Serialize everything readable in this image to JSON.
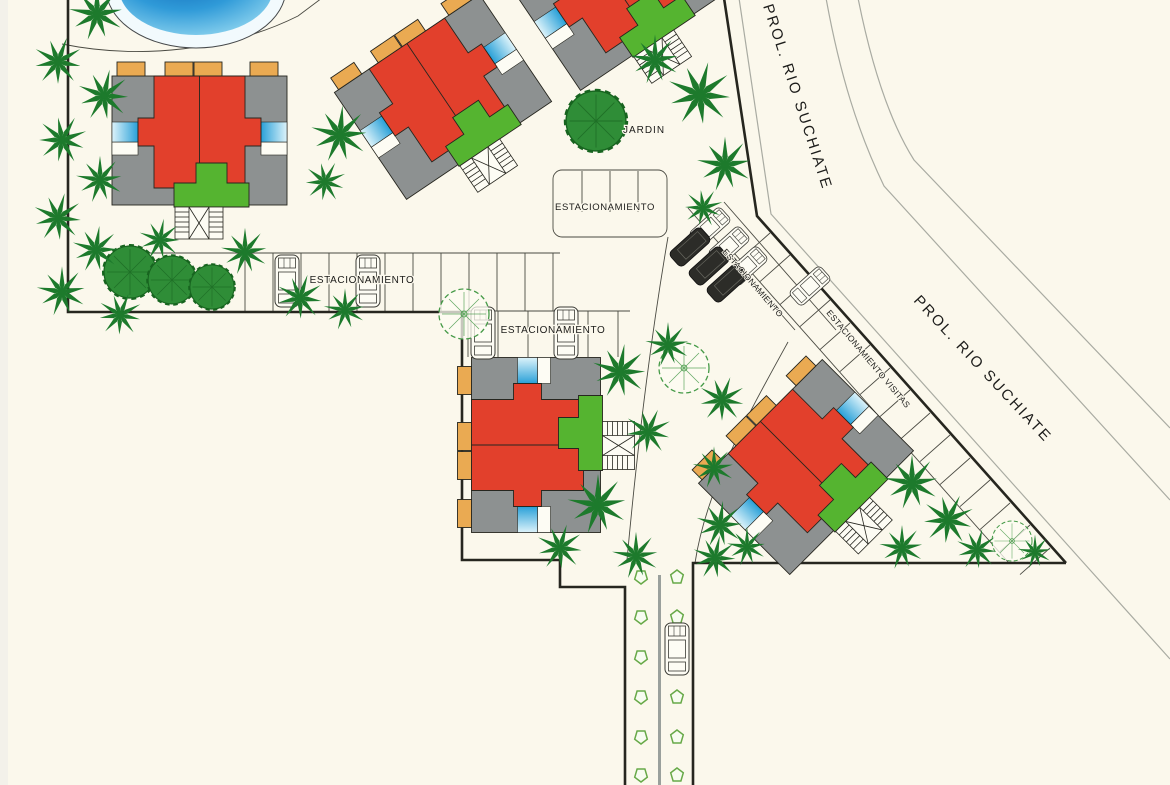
{
  "labels": {
    "street": "PROL. RIO SUCHIATE",
    "garden": "JARDIN",
    "parking": "ESTACIONAMIENTO",
    "visitor_parking": "ESTACIONAMIENTO VISITAS"
  },
  "features": {
    "buildings_visible": 5,
    "swimming_pool": 1,
    "parked_cars": 12,
    "street_median_shrubs": 12
  },
  "colors": {
    "paper": "#fbf8ec",
    "line-dark": "#26261f",
    "roof-red": "#e2402c",
    "roof-gray": "#8d9191",
    "trim-orange": "#eaaa52",
    "entry-green": "#55b430",
    "accent-blue": "#2fa3dc",
    "pool-blue": "#1b7fd0",
    "tree-green": "#1d7a2c",
    "shrub-green": "#67a948"
  }
}
